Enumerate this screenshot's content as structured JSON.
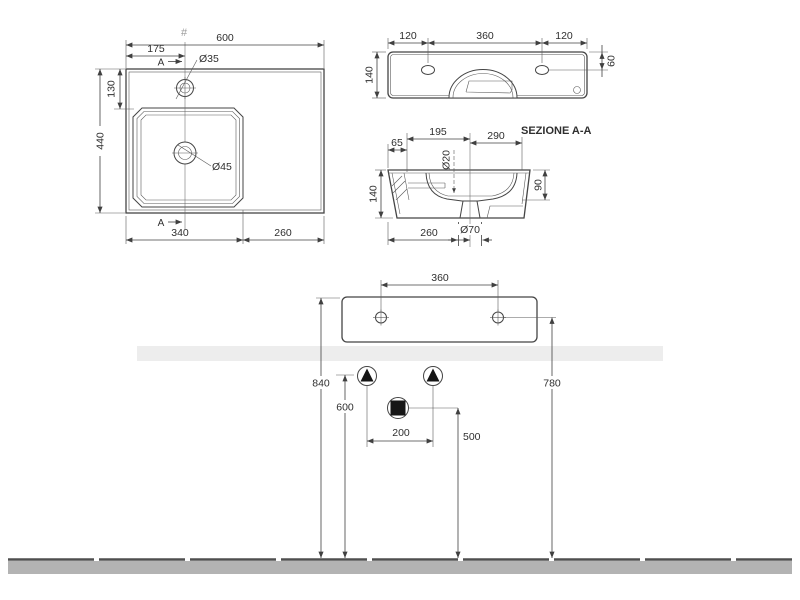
{
  "colors": {
    "ink": "#404040",
    "wall_band": "#ededed",
    "floor_band": "#b3b3b3",
    "floor_line": "#4f4f4f"
  },
  "plan": {
    "hash": "#",
    "width": "600",
    "tap_offset": "175",
    "depth": "440",
    "rim_offset": "130",
    "basin_width": "340",
    "shelf_width": "260",
    "tap_hole": "Ø35",
    "drain_hole": "Ø45",
    "section_top": "A",
    "section_bottom": "A"
  },
  "back": {
    "left_offset": "120",
    "hole_spacing": "360",
    "right_offset": "120",
    "height": "140",
    "hole_drop": "60"
  },
  "section": {
    "title": "SEZIONE A-A",
    "tap_to_center": "195",
    "center_to_front": "290",
    "back_ledge": "65",
    "side_hole": "Ø20",
    "height": "140",
    "bowl_depth": "90",
    "base_depth": "260",
    "drain_hole": "Ø70"
  },
  "install": {
    "hole_spacing": "360",
    "rim_height": "840",
    "hole_height": "780",
    "supply_height": "600",
    "supply_spacing": "200",
    "drain_height": "500"
  }
}
